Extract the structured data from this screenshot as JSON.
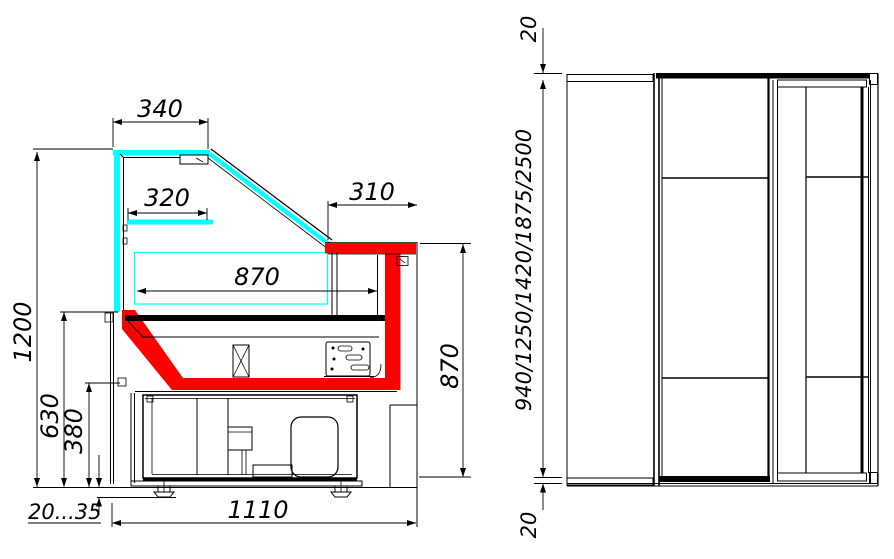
{
  "colors": {
    "glass_cyan": "#00ffff",
    "accent_red": "#ff0000",
    "line_black": "#000000",
    "background": "#ffffff"
  },
  "side_view": {
    "dim_canopy_width": "340",
    "dim_shelf_width": "320",
    "dim_worktop_width": "310",
    "dim_display_depth": "870",
    "dim_overall_height": "1200",
    "dim_worktop_height": "630",
    "dim_base_height": "380",
    "dim_foot_adjustment": "20...35",
    "dim_base_width": "1110",
    "dim_back_height": "870"
  },
  "front_view": {
    "dim_top_panel": "20",
    "dim_length_options": "940/1250/1420/1875/2500",
    "dim_bottom_panel": "20"
  }
}
